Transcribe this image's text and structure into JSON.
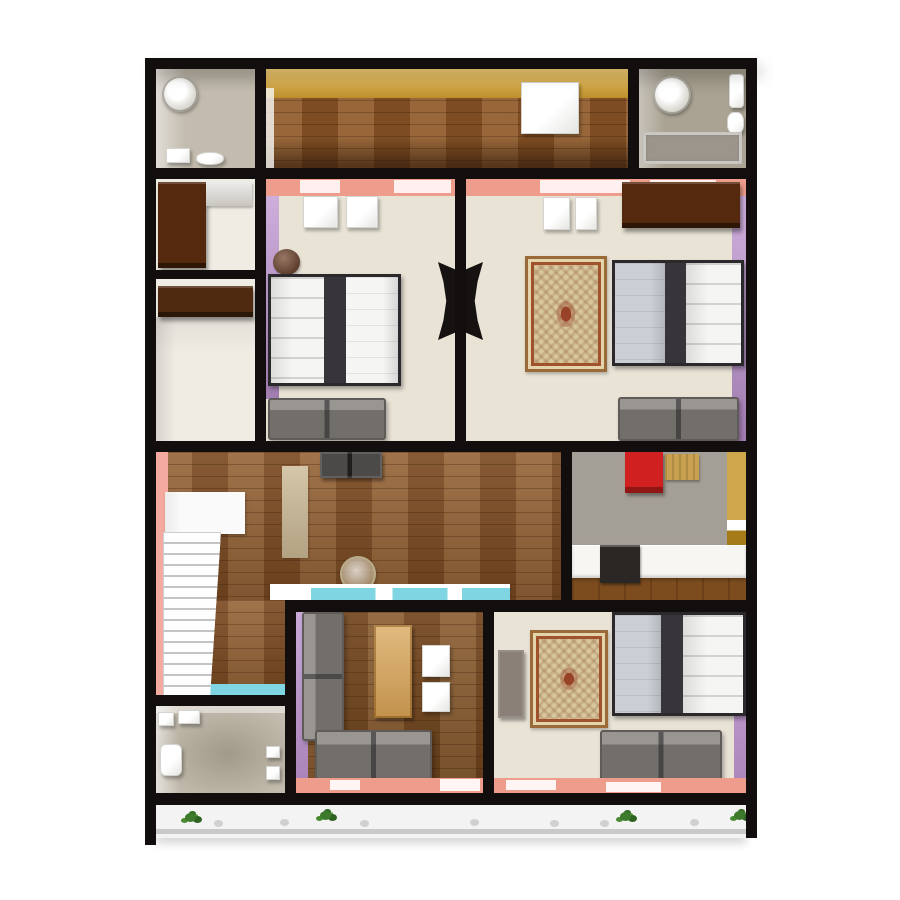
{
  "meta": {
    "type": "3d-floorplan-render",
    "description": "Top-down 3D rendered apartment floor plan on white background",
    "canvas_width": 900,
    "canvas_height": 900,
    "visible_text": "none"
  },
  "palette": {
    "background": "#ffffff",
    "wall": "#120e0e",
    "door_black": "#171212",
    "wood": "#8a5527",
    "wood_dark": "#7c4c1f",
    "yellow_wall": "#e3b343",
    "kitchen_yellow": "#c2901f",
    "salmon_wall": "#ee9d8c",
    "purple_wall": "#bd93cf",
    "pink_wall": "#f4aa9e",
    "beige_floor": "#e9e3d6",
    "closet_floor": "#efece4",
    "bath_floor": "#c3bcae",
    "bath_floor_dark": "#aaa393",
    "kitchen_floor": "#a49f96",
    "cyan_accent": "#7fd6e2",
    "white_fixture": "#f7f7f5",
    "sofa_gray": "#7c7874",
    "wardrobe_brown": "#54290e",
    "shelf_brown": "#4f2a10",
    "gray_wardrobe": "#8a8078",
    "rug_base": "#d8c79d",
    "red_cabinet": "#d02020",
    "tan_cabinet": "#c8a050",
    "coffee_table_tan": "#d8a355",
    "tub_gray": "#9b958b",
    "counter_white": "#f7f6f2",
    "stove_black": "#2a2724",
    "bed_band_dark": "#37353a",
    "bed_gray_blue": "#ccd0d6",
    "bed_white": "#f5f5f3",
    "stool_brown": "#6b3c22",
    "runner_tan": "#cbb894",
    "balcony_floor": "#f3f3f3",
    "rail_gray": "#c9c9c9",
    "plant_green": "#3e7a2c",
    "stair_white": "#fafafa",
    "tv_black": "#201c1a"
  },
  "rooms": [
    {
      "id": "bathroom-top-left",
      "name": "bathroom",
      "furniture": [
        "round-basin",
        "toilet",
        "cistern"
      ]
    },
    {
      "id": "hall-top",
      "name": "upper hallway / kitchen strip",
      "furniture": [
        "white-cabinet"
      ],
      "accent": "yellow rear wall, wood floor"
    },
    {
      "id": "bathroom-top-right",
      "name": "bathroom",
      "furniture": [
        "round-basin",
        "toilet",
        "bathtub"
      ]
    },
    {
      "id": "closet-upper-left",
      "name": "wardrobe nook",
      "furniture": [
        "dark-wood-wardrobe",
        "shelf"
      ]
    },
    {
      "id": "closet-lower-left",
      "name": "storage nook",
      "furniture": [
        "dark-wood-shelf"
      ]
    },
    {
      "id": "bedroom-left",
      "name": "bedroom",
      "furniture": [
        "double-bed",
        "sofa",
        "nightstand",
        "nightstand",
        "round-stool"
      ],
      "accents": [
        "salmon wall",
        "purple wall"
      ]
    },
    {
      "id": "bedroom-right",
      "name": "bedroom",
      "furniture": [
        "double-bed",
        "sofa",
        "ornate-rug",
        "dark-wood-wardrobe",
        "nightstand",
        "nightstand"
      ],
      "accents": [
        "salmon wall",
        "purple wall"
      ]
    },
    {
      "id": "living-dining",
      "name": "living / dining hall",
      "furniture": [
        "tv-cabinet",
        "staircase",
        "carpet-runner",
        "round-glass-table",
        "cyan-breakfast-bar"
      ],
      "accents": [
        "pink stair wall",
        "wood floor"
      ]
    },
    {
      "id": "kitchen",
      "name": "kitchen",
      "furniture": [
        "red-cabinet",
        "tan-cabinet",
        "counter",
        "stove"
      ],
      "accents": [
        "yellow wall",
        "gray floor"
      ]
    },
    {
      "id": "family-room",
      "name": "family room",
      "furniture": [
        "corner-sofa",
        "coffee-table",
        "side-table",
        "side-table"
      ],
      "accents": [
        "salmon wall",
        "purple wall"
      ]
    },
    {
      "id": "bedroom-bottom",
      "name": "bedroom",
      "furniture": [
        "double-bed",
        "sofa",
        "ornate-rug",
        "gray-wardrobe"
      ],
      "accents": [
        "salmon wall",
        "purple wall"
      ]
    },
    {
      "id": "bathroom-bottom-left",
      "name": "bathroom",
      "furniture": [
        "toilet",
        "shower-fittings",
        "shelf-boxes"
      ]
    },
    {
      "id": "balcony",
      "name": "balcony",
      "furniture": [
        "plants",
        "railing",
        "small-pots"
      ]
    }
  ]
}
